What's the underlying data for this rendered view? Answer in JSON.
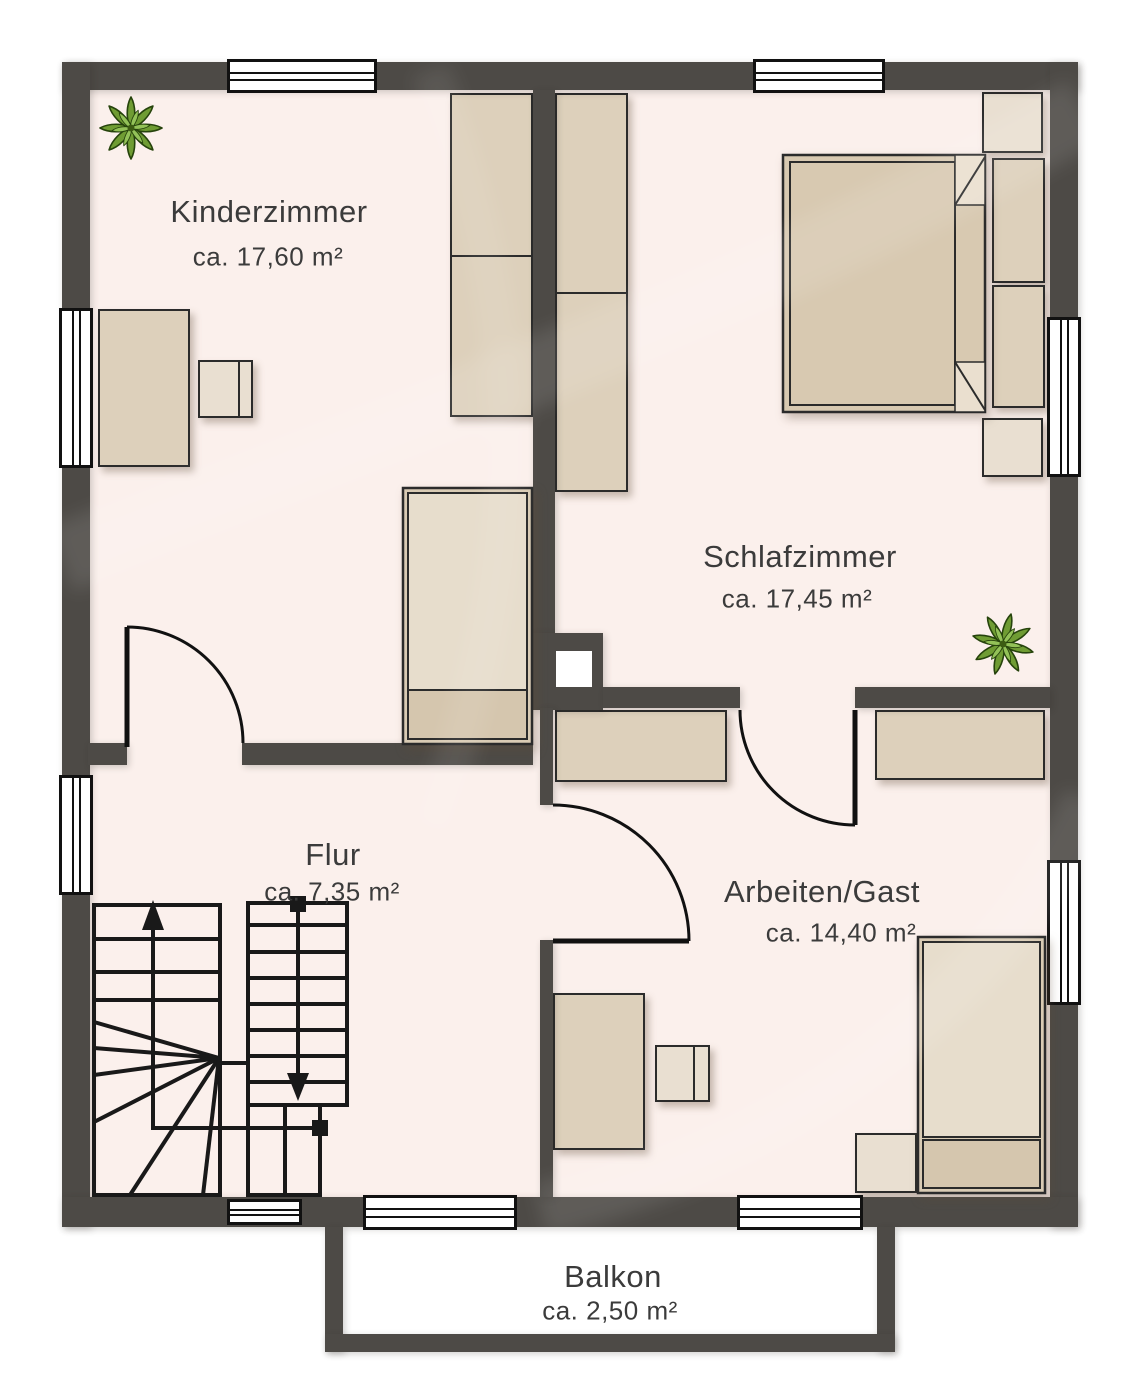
{
  "rooms": [
    {
      "name": "Kinderzimmer",
      "area": "ca. 17,60 m²"
    },
    {
      "name": "Schlafzimmer",
      "area": "ca. 17,45 m²"
    },
    {
      "name": "Flur",
      "area": "ca. 7,35 m²"
    },
    {
      "name": "Arbeiten/Gast",
      "area": "ca. 14,40 m²"
    },
    {
      "name": "Balkon",
      "area": "ca. 2,50 m²"
    }
  ],
  "colors": {
    "wall": "#4d4a46",
    "room_floor": "#fbf0ec",
    "balcony_floor": "#ffffff",
    "furniture": "#ddd0bb",
    "furniture_light": "#e7ddcc",
    "furniture_dark": "#d5c6ae",
    "outline": "#1c1c1c",
    "label_text": "#3b3b3b",
    "plant_green": "#739d36"
  },
  "symbols": {
    "plants": [
      "plant-icon",
      "plant-icon"
    ],
    "stair_up_arrow": "up-arrow-icon",
    "stair_down_arrow": "down-arrow-icon",
    "door_swings": 3,
    "windows": 9
  }
}
